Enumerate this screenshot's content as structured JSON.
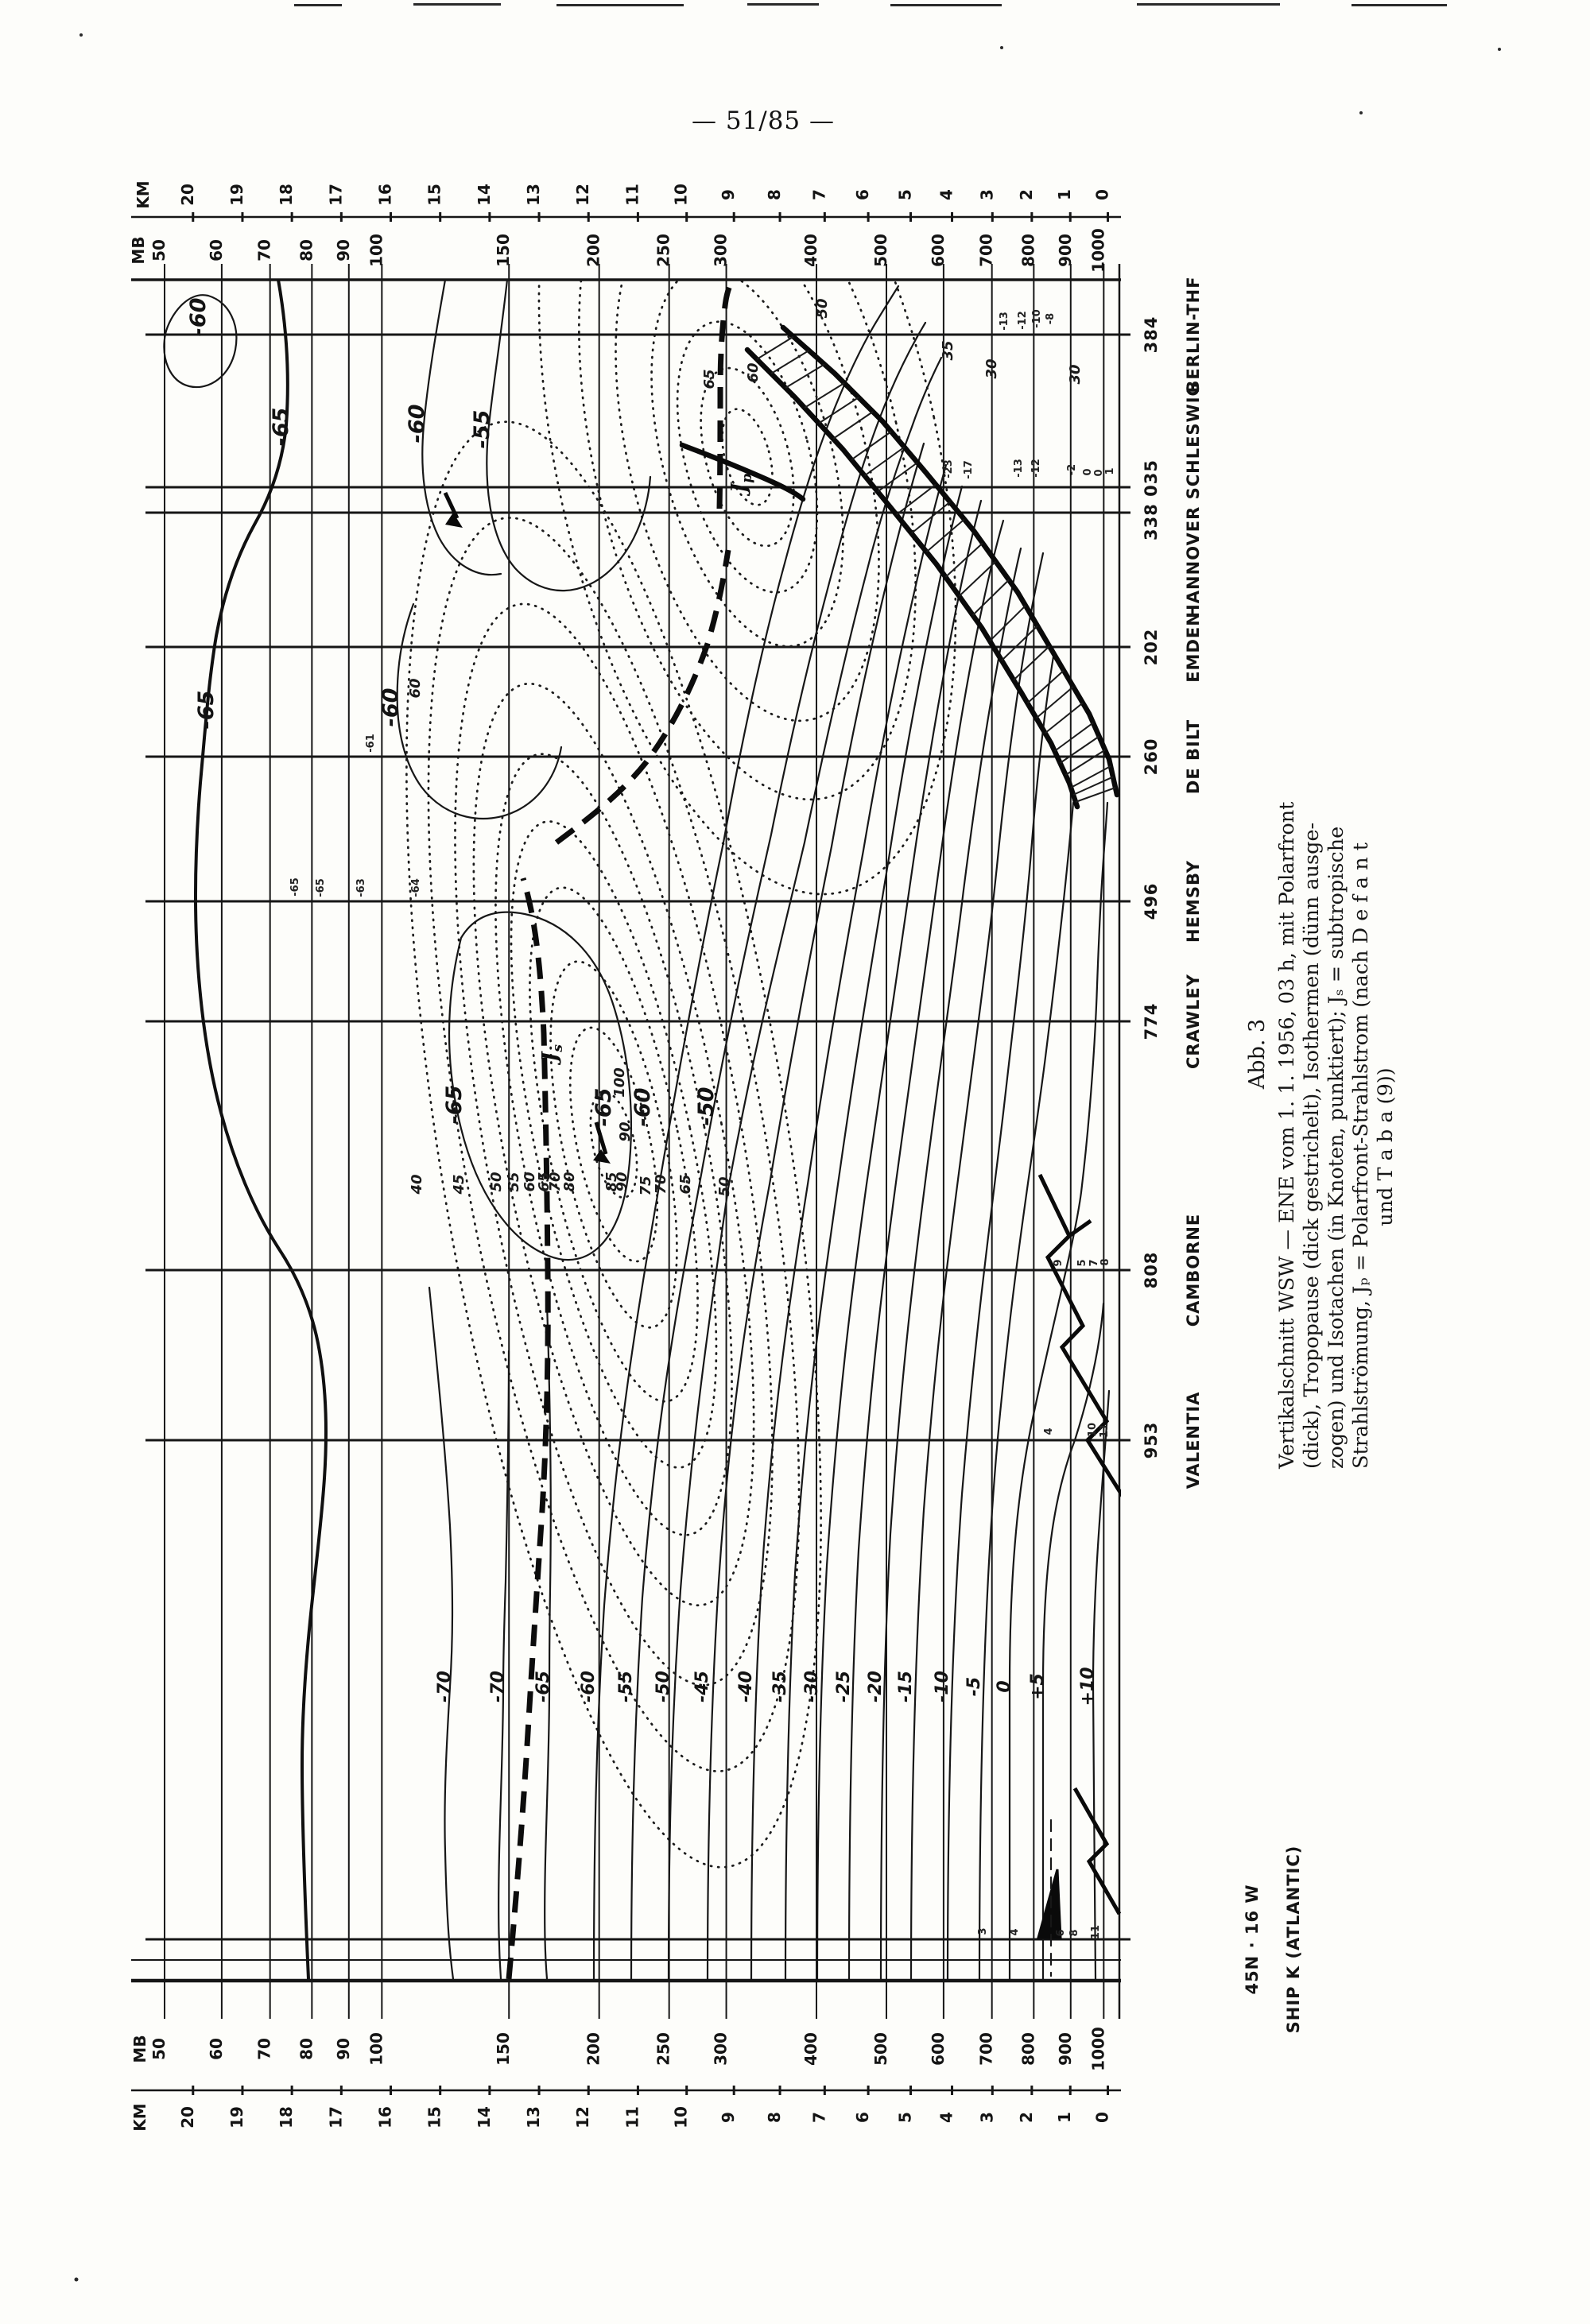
{
  "page": {
    "number": "— 51/85 —"
  },
  "figure": {
    "number": "Abb. 3",
    "caption_lines": [
      "Vertikalschnitt WSW — ENE vom 1. 1. 1956, 03 h, mit Polarfront",
      "(dick), Tropopause (dick gestrichelt), Isothermen (dünn ausge-",
      "zogen) und Isotachen (in Knoten, punktiert); Jₛ = subtropische",
      "Strahlströmung, Jₚ = Polarfront-Strahlstrom (nach D e f a n t",
      "und T a b a (9))"
    ],
    "axes": {
      "km_unit": "KM",
      "mb_unit": "MB",
      "km_ticks": [
        20,
        19,
        18,
        17,
        16,
        15,
        14,
        13,
        12,
        11,
        10,
        9,
        8,
        7,
        6,
        5,
        4,
        3,
        2,
        1,
        0
      ],
      "mb_ticks": [
        50,
        60,
        70,
        80,
        90,
        100,
        150,
        200,
        250,
        300,
        400,
        500,
        600,
        700,
        800,
        900,
        1000
      ]
    },
    "stations": [
      {
        "code": "384",
        "name": "BERLIN-THF",
        "y": 421,
        "lines": [
          421
        ]
      },
      {
        "code": "338 035",
        "name": "HANNOVER SCHLESWIG",
        "y": 629,
        "lines": [
          613,
          645
        ]
      },
      {
        "code": "202",
        "name": "EMDEN",
        "y": 814,
        "lines": [
          814
        ]
      },
      {
        "code": "260",
        "name": "DE BILT",
        "y": 952,
        "lines": [
          952
        ]
      },
      {
        "code": "496",
        "name": "HEMSBY",
        "y": 1134,
        "lines": [
          1134
        ]
      },
      {
        "code": "774",
        "name": "CRAWLEY",
        "y": 1285,
        "lines": [
          1285
        ]
      },
      {
        "code": "808",
        "name": "CAMBORNE",
        "y": 1598,
        "lines": [
          1598
        ]
      },
      {
        "code": "953",
        "name": "VALENTIA",
        "y": 1812,
        "lines": [
          1812
        ]
      },
      {
        "code": "45N · 16 W",
        "name": "SHIP K (ATLANTIC)",
        "y": 2440,
        "lines": [
          2440
        ],
        "cx": 1582,
        "nx": 1634
      }
    ],
    "isotherm_labels": [
      {
        "t": "-65",
        "x": 362,
        "y": 537,
        "big": true
      },
      {
        "t": "-65",
        "x": 268,
        "y": 893,
        "big": true
      },
      {
        "t": "-60",
        "x": 258,
        "y": 399,
        "big": true
      },
      {
        "t": "-60",
        "x": 533,
        "y": 533,
        "big": true
      },
      {
        "t": "-60",
        "x": 500,
        "y": 890,
        "big": true
      },
      {
        "t": "-55",
        "x": 615,
        "y": 540,
        "big": true
      },
      {
        "t": "-65",
        "x": 580,
        "y": 1390,
        "big": true
      },
      {
        "t": "-65",
        "x": 768,
        "y": 1393,
        "big": true
      },
      {
        "t": "-60",
        "x": 817,
        "y": 1393,
        "big": true
      },
      {
        "t": "-50",
        "x": 897,
        "y": 1392,
        "big": true
      },
      {
        "t": "-70",
        "x": 566,
        "y": 2122
      },
      {
        "t": "-70",
        "x": 633,
        "y": 2122
      },
      {
        "t": "-65",
        "x": 690,
        "y": 2122
      },
      {
        "t": "-60",
        "x": 747,
        "y": 2122
      },
      {
        "t": "-55",
        "x": 794,
        "y": 2122
      },
      {
        "t": "-50",
        "x": 841,
        "y": 2122
      },
      {
        "t": "-45",
        "x": 890,
        "y": 2122
      },
      {
        "t": "-40",
        "x": 945,
        "y": 2122
      },
      {
        "t": "-35",
        "x": 988,
        "y": 2122
      },
      {
        "t": "-30",
        "x": 1028,
        "y": 2122
      },
      {
        "t": "-25",
        "x": 1068,
        "y": 2122
      },
      {
        "t": "-20",
        "x": 1108,
        "y": 2122
      },
      {
        "t": "-15",
        "x": 1146,
        "y": 2122
      },
      {
        "t": "-10",
        "x": 1192,
        "y": 2122
      },
      {
        "t": "-5",
        "x": 1232,
        "y": 2122
      },
      {
        "t": "0",
        "x": 1270,
        "y": 2122
      },
      {
        "t": "+5",
        "x": 1312,
        "y": 2122
      },
      {
        "t": "+10",
        "x": 1375,
        "y": 2122
      }
    ],
    "isotach_labels": [
      {
        "t": "100",
        "x": 785,
        "y": 1362
      },
      {
        "t": "90",
        "x": 792,
        "y": 1424
      },
      {
        "t": "40",
        "x": 530,
        "y": 1490
      },
      {
        "t": "45",
        "x": 583,
        "y": 1490
      },
      {
        "t": "50",
        "x": 630,
        "y": 1487
      },
      {
        "t": "55",
        "x": 652,
        "y": 1487
      },
      {
        "t": "60",
        "x": 672,
        "y": 1487
      },
      {
        "t": "65",
        "x": 690,
        "y": 1487
      },
      {
        "t": "70",
        "x": 704,
        "y": 1487
      },
      {
        "t": "80",
        "x": 722,
        "y": 1487
      },
      {
        "t": "85",
        "x": 775,
        "y": 1487
      },
      {
        "t": "90",
        "x": 788,
        "y": 1487
      },
      {
        "t": "75",
        "x": 818,
        "y": 1492
      },
      {
        "t": "70",
        "x": 837,
        "y": 1490
      },
      {
        "t": "65",
        "x": 868,
        "y": 1490
      },
      {
        "t": "50",
        "x": 917,
        "y": 1493
      },
      {
        "t": "60",
        "x": 528,
        "y": 866
      },
      {
        "t": "65",
        "x": 898,
        "y": 477
      },
      {
        "t": "60",
        "x": 953,
        "y": 469
      },
      {
        "t": "50",
        "x": 1040,
        "y": 388
      },
      {
        "t": "35",
        "x": 1198,
        "y": 441
      },
      {
        "t": "30",
        "x": 1253,
        "y": 464
      },
      {
        "t": "30",
        "x": 1358,
        "y": 471
      }
    ],
    "jets": [
      {
        "main": "J",
        "sub": "p",
        "x": 938,
        "y": 608
      },
      {
        "main": "J",
        "sub": "s",
        "x": 700,
        "y": 1325
      }
    ],
    "plotted_values": [
      {
        "v": "-13",
        "x": 1267,
        "y": 404
      },
      {
        "v": "-12",
        "x": 1290,
        "y": 403
      },
      {
        "v": "-10",
        "x": 1308,
        "y": 401
      },
      {
        "v": "-8",
        "x": 1325,
        "y": 401
      },
      {
        "v": "-23",
        "x": 1197,
        "y": 590
      },
      {
        "v": "-17",
        "x": 1222,
        "y": 591
      },
      {
        "v": "-13",
        "x": 1285,
        "y": 589
      },
      {
        "v": "-12",
        "x": 1307,
        "y": 589
      },
      {
        "v": "-2",
        "x": 1352,
        "y": 591
      },
      {
        "v": "0",
        "x": 1372,
        "y": 594
      },
      {
        "v": "0",
        "x": 1386,
        "y": 595
      },
      {
        "v": "1",
        "x": 1400,
        "y": 593
      },
      {
        "v": "-61",
        "x": 470,
        "y": 935
      },
      {
        "v": "-65",
        "x": 375,
        "y": 1116
      },
      {
        "v": "-65",
        "x": 407,
        "y": 1117
      },
      {
        "v": "-63",
        "x": 458,
        "y": 1117
      },
      {
        "v": "-64",
        "x": 527,
        "y": 1117
      },
      {
        "v": "9",
        "x": 1335,
        "y": 1589
      },
      {
        "v": "5",
        "x": 1365,
        "y": 1589
      },
      {
        "v": "7",
        "x": 1380,
        "y": 1589
      },
      {
        "v": "8",
        "x": 1394,
        "y": 1588
      },
      {
        "v": "4",
        "x": 1323,
        "y": 1801
      },
      {
        "v": "10",
        "x": 1378,
        "y": 1799
      },
      {
        "v": "11",
        "x": 1393,
        "y": 1800
      },
      {
        "v": "3",
        "x": 1240,
        "y": 2430
      },
      {
        "v": "4",
        "x": 1280,
        "y": 2431
      },
      {
        "v": "6",
        "x": 1338,
        "y": 2432
      },
      {
        "v": "8",
        "x": 1355,
        "y": 2432
      },
      {
        "v": "11",
        "x": 1382,
        "y": 2431
      }
    ]
  },
  "chart_data": {
    "type": "line",
    "subtype": "meteorological-vertical-cross-section (rotated 90° on page, contour analysis)",
    "title": "Abb. 3 — Vertikalschnitt WSW — ENE vom 1. 1. 1956, 03 h",
    "xlabel": "stations along WSW–ENE section",
    "ylabel": "pressure MB (log, 50–1000) / height KM (0–20)",
    "axis_pressure_mb": [
      50,
      60,
      70,
      80,
      90,
      100,
      150,
      200,
      250,
      300,
      400,
      500,
      600,
      700,
      800,
      900,
      1000
    ],
    "axis_height_km_range": [
      0,
      20
    ],
    "stations": [
      "SHIP K (ATLANTIC) 45N·16W",
      "VALENTIA 953",
      "CAMBORNE 808",
      "CRAWLEY 774",
      "HEMSBY 496",
      "DE BILT 260",
      "EMDEN 202",
      "HANNOVER/SCHLESWIG 338 035",
      "BERLIN-THF 384"
    ],
    "series": [
      {
        "name": "Isothermen (°C, dünn ausgezogen)",
        "levels": [
          -70,
          -65,
          -60,
          -55,
          -50,
          -45,
          -40,
          -35,
          -30,
          -25,
          -20,
          -15,
          -10,
          -5,
          0,
          5,
          10
        ]
      },
      {
        "name": "Isotachen (Knoten, punktiert)",
        "levels": [
          30,
          35,
          40,
          45,
          50,
          55,
          60,
          65,
          70,
          75,
          80,
          85,
          90,
          100
        ]
      }
    ],
    "annotations": [
      "Polarfront (dick) – sloping frontal zone with hatching, from ~300 mb near Hannover to surface near De Bilt",
      "Tropopause (dick gestrichelt) – broken at jet axes",
      "Jₛ = subtropische Strahlströmung, core > 100 kt near 200 mb above Camborne/Crawley",
      "Jₚ = Polarfront-Strahlstrom, core ~65 kt near 300 mb above Hannover/Schleswig"
    ],
    "legend_position": "caption below figure (page rotated)",
    "grid": true
  }
}
